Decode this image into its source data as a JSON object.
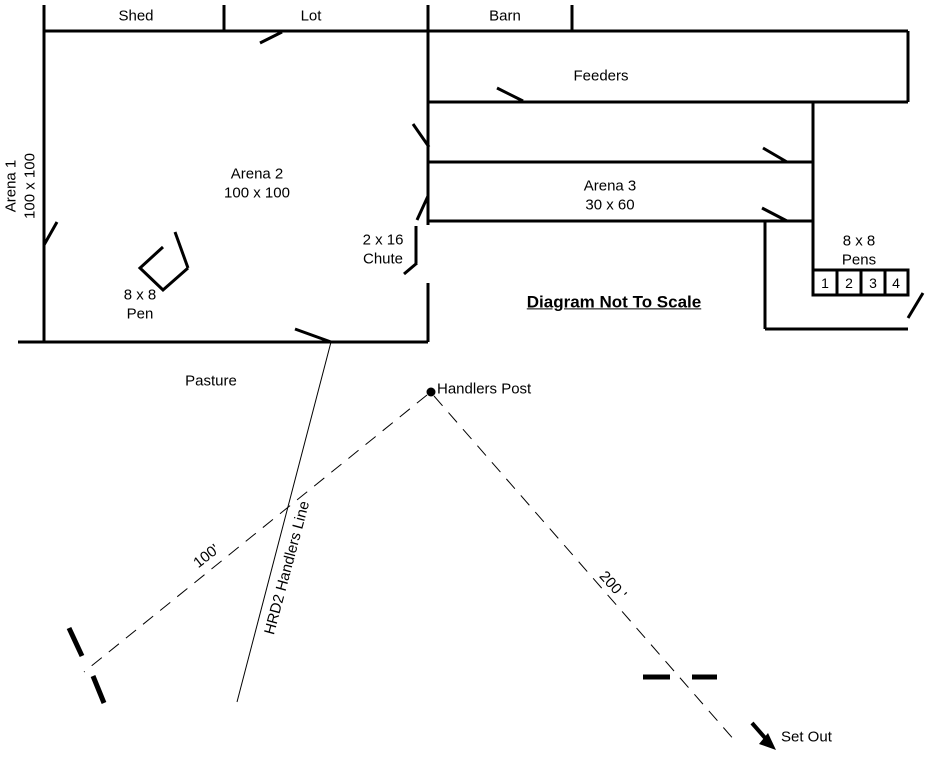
{
  "labels": {
    "shed": "Shed",
    "lot": "Lot",
    "barn": "Barn",
    "feeders": "Feeders",
    "arena1_name": "Arena 1",
    "arena1_size": "100 x 100",
    "arena2_name": "Arena 2",
    "arena2_size": "100 x 100",
    "arena3_name": "Arena 3",
    "arena3_size": "30 x 60",
    "chute_size": "2 x 16",
    "chute_name": "Chute",
    "pens_size": "8 x 8",
    "pens_name": "Pens",
    "pen_numbers": [
      "1",
      "2",
      "3",
      "4"
    ],
    "pen_size": "8 x 8",
    "pen_name": "Pen",
    "note": "Diagram Not To Scale",
    "pasture": "Pasture",
    "handlers_post": "Handlers Post",
    "handlers_line": "HRD2 Handlers Line",
    "distance_100": "100'",
    "distance_200": "200 '",
    "set_out": "Set Out"
  },
  "colors": {
    "ink": "#000000",
    "background": "#ffffff"
  }
}
